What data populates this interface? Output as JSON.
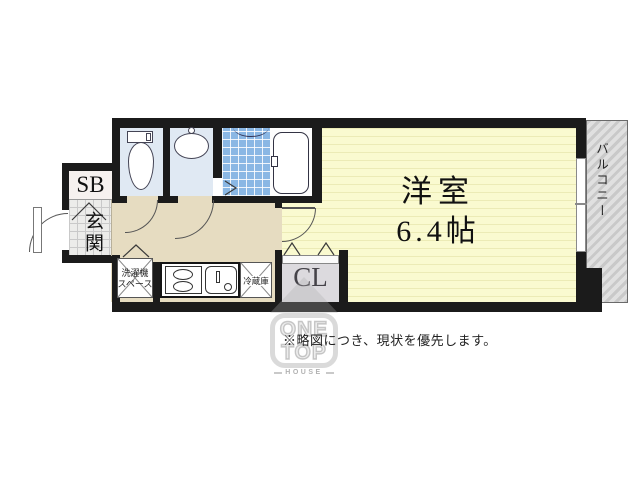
{
  "plan": {
    "main_room": {
      "name": "洋室",
      "size": "6.4帖"
    },
    "balcony_label": "バルコニー",
    "shoe_box_label": "SB",
    "entrance_label": "玄関",
    "closet_label": "CL",
    "washer_label_1": "洗濯機",
    "washer_label_2": "スペース",
    "fridge_label": "冷蔵庫"
  },
  "note_text": "※略図につき、現状を優先します。",
  "watermark": {
    "line1": "ONE",
    "line2": "TOP",
    "line3": "HOUSE"
  },
  "colors": {
    "wall": "#1b1b1b",
    "main_room_floor": "#fafad0",
    "hallway_floor": "#e6dcc1",
    "wet_room": "#e0e9f3",
    "bath_tile": "#8ab7e4",
    "genkan_tile": "#ececea",
    "closet_body": "#dcdade",
    "balcony_stripe": "#c9c9c9"
  }
}
